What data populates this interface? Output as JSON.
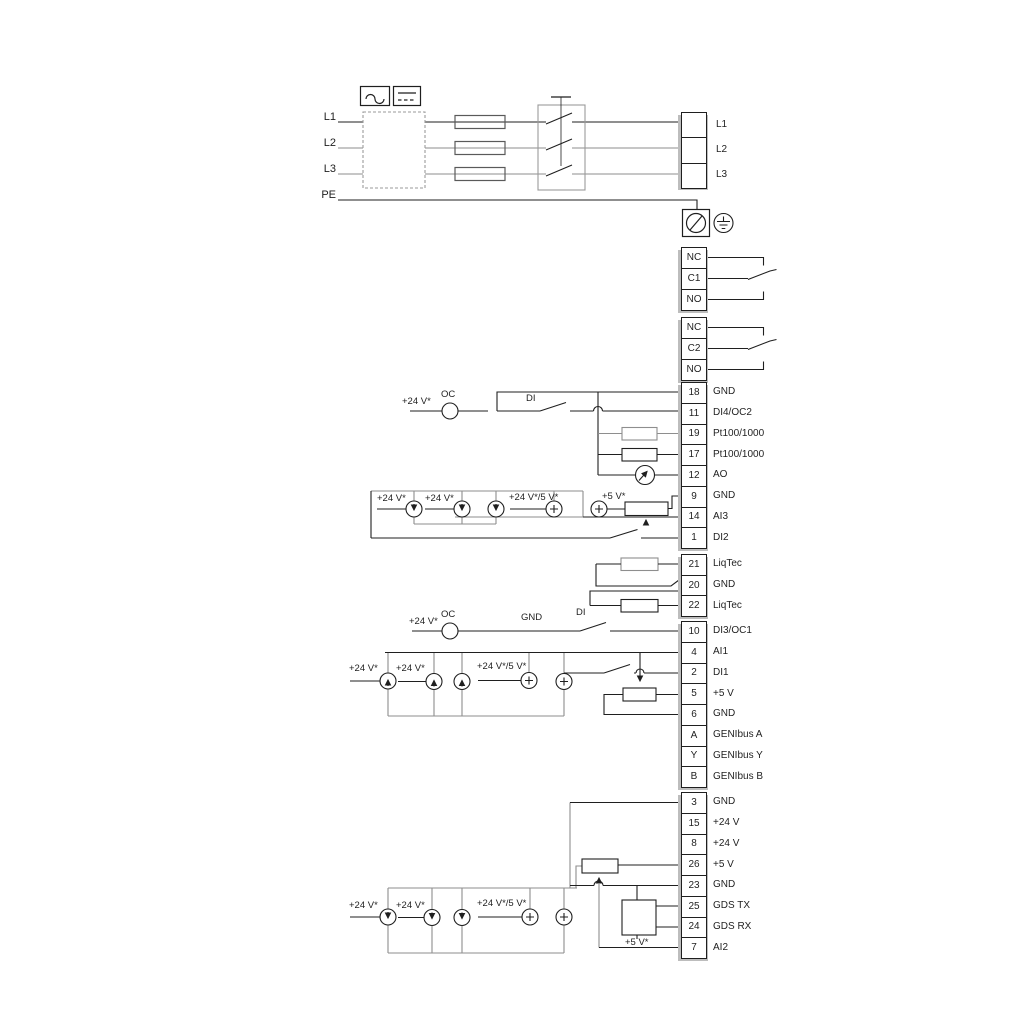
{
  "diagram_title": "frequency-converter-wiring-diagram",
  "colors": {
    "wire_black": "#1f1f1f",
    "wire_gray": "#8e8e8e",
    "terminal_shadow": "#bdbdbd",
    "background": "#ffffff"
  },
  "mains": {
    "inputs": [
      "L1",
      "L2",
      "L3",
      "PE"
    ],
    "output_terminals": [
      "L1",
      "L2",
      "L3"
    ]
  },
  "relays": {
    "relay1": [
      "NC",
      "C1",
      "NO"
    ],
    "relay2": [
      "NC",
      "C2",
      "NO"
    ]
  },
  "terminal_blocks": {
    "io1": [
      {
        "num": "18",
        "label": "GND"
      },
      {
        "num": "11",
        "label": "DI4/OC2"
      },
      {
        "num": "19",
        "label": "Pt100/1000"
      },
      {
        "num": "17",
        "label": "Pt100/1000"
      },
      {
        "num": "12",
        "label": "AO"
      },
      {
        "num": "9",
        "label": "GND"
      },
      {
        "num": "14",
        "label": "AI3"
      },
      {
        "num": "1",
        "label": "DI2"
      }
    ],
    "liqtec": [
      {
        "num": "21",
        "label": "LiqTec"
      },
      {
        "num": "20",
        "label": "GND"
      },
      {
        "num": "22",
        "label": "LiqTec"
      }
    ],
    "io2": [
      {
        "num": "10",
        "label": "DI3/OC1"
      },
      {
        "num": "4",
        "label": "AI1"
      },
      {
        "num": "2",
        "label": "DI1"
      },
      {
        "num": "5",
        "label": "+5 V"
      },
      {
        "num": "6",
        "label": "GND"
      },
      {
        "num": "A",
        "label": "GENIbus A"
      },
      {
        "num": "Y",
        "label": "GENIbus Y"
      },
      {
        "num": "B",
        "label": "GENIbus B"
      }
    ],
    "io3": [
      {
        "num": "3",
        "label": "GND"
      },
      {
        "num": "15",
        "label": "+24 V"
      },
      {
        "num": "8",
        "label": "+24 V"
      },
      {
        "num": "26",
        "label": "+5 V"
      },
      {
        "num": "23",
        "label": "GND"
      },
      {
        "num": "25",
        "label": "GDS TX"
      },
      {
        "num": "24",
        "label": "GDS RX"
      },
      {
        "num": "7",
        "label": "AI2"
      }
    ]
  },
  "annotations": {
    "oc2_supply": "+24 V*",
    "oc2_oc": "OC",
    "oc2_di": "DI",
    "ai3_s1": "+24 V*",
    "ai3_s2": "+24 V*",
    "ai3_s3": "+24 V*/5 V*",
    "ai3_5v": "+5 V*",
    "oc1_supply": "+24 V*",
    "oc1_oc": "OC",
    "oc1_gnd": "GND",
    "oc1_di": "DI",
    "ai1_s1": "+24 V*",
    "ai1_s2": "+24 V*",
    "ai1_s3": "+24 V*/5 V*",
    "ai2_s1": "+24 V*",
    "ai2_s2": "+24 V*",
    "ai2_s3": "+24 V*/5 V*",
    "gds_5v": "+5 V*"
  }
}
